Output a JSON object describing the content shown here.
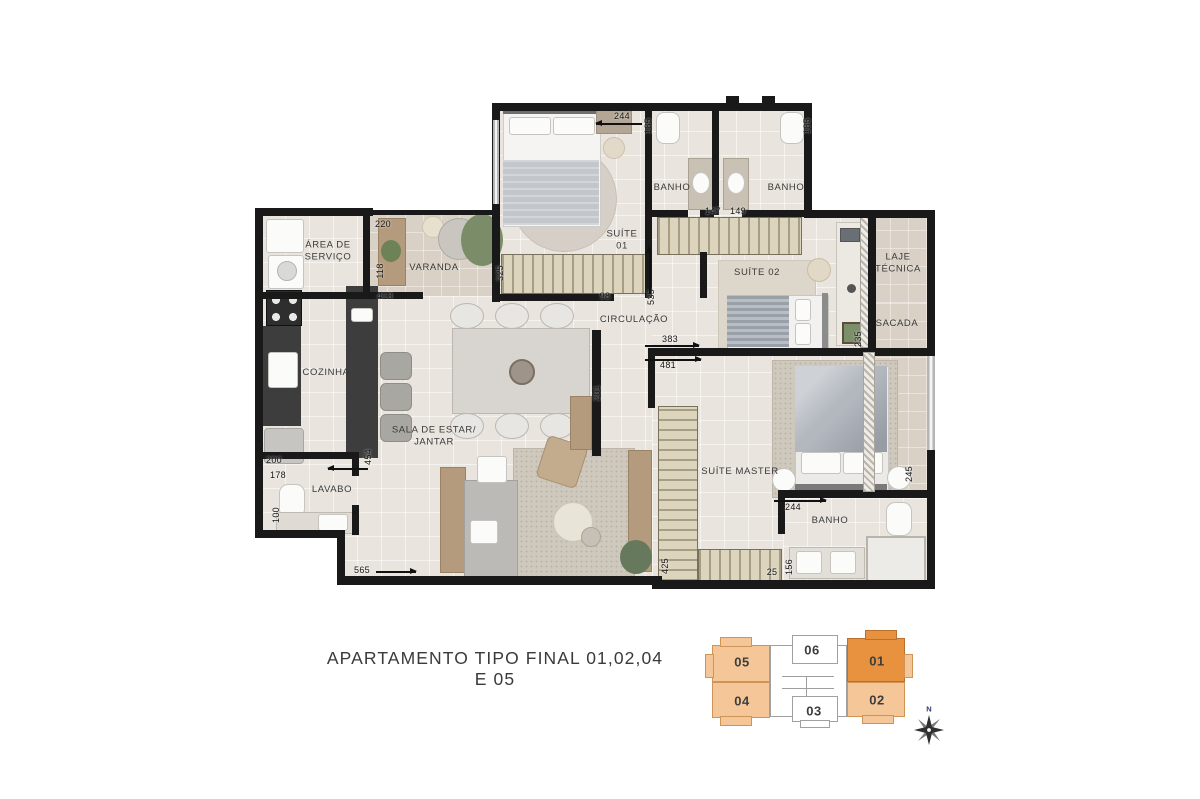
{
  "title": "APARTAMENTO TIPO FINAL 01,02,04 E 05",
  "plan": {
    "rooms": [
      {
        "label": "ÁREA DE SERVIÇO"
      },
      {
        "label": "VARANDA"
      },
      {
        "label": "SUÍTE 01"
      },
      {
        "label": "BANHO"
      },
      {
        "label": "BANHO"
      },
      {
        "label": "SUÍTE 02"
      },
      {
        "label": "LAJE TÉCNICA"
      },
      {
        "label": "SACADA"
      },
      {
        "label": "CIRCULAÇÃO"
      },
      {
        "label": "COZINHA"
      },
      {
        "label": "SALA DE ESTAR/ JANTAR"
      },
      {
        "label": "LAVABO"
      },
      {
        "label": "SUÍTE MASTER"
      },
      {
        "label": "BANHO"
      }
    ],
    "dimensions_cm": [
      "244",
      "185",
      "185",
      "147",
      "149",
      "220",
      "118",
      "413",
      "325",
      "98",
      "535",
      "383",
      "481",
      "235",
      "201",
      "454",
      "200",
      "178",
      "100",
      "565",
      "425",
      "25",
      "156",
      "244",
      "245"
    ]
  },
  "keyplan": {
    "units": [
      {
        "label": "05",
        "tone": "orange-light"
      },
      {
        "label": "06",
        "tone": "white"
      },
      {
        "label": "01",
        "tone": "orange-dark"
      },
      {
        "label": "04",
        "tone": "orange-light"
      },
      {
        "label": "03",
        "tone": "white"
      },
      {
        "label": "02",
        "tone": "orange-light"
      }
    ]
  },
  "compass": {
    "north_label": "N"
  },
  "colors": {
    "wall": "#191919",
    "floor": "#e9e4de",
    "balcony_floor": "#d9d1c6",
    "unit_highlight": "#e8913f",
    "unit_light": "#f5c697",
    "text": "#3a3a3a"
  }
}
